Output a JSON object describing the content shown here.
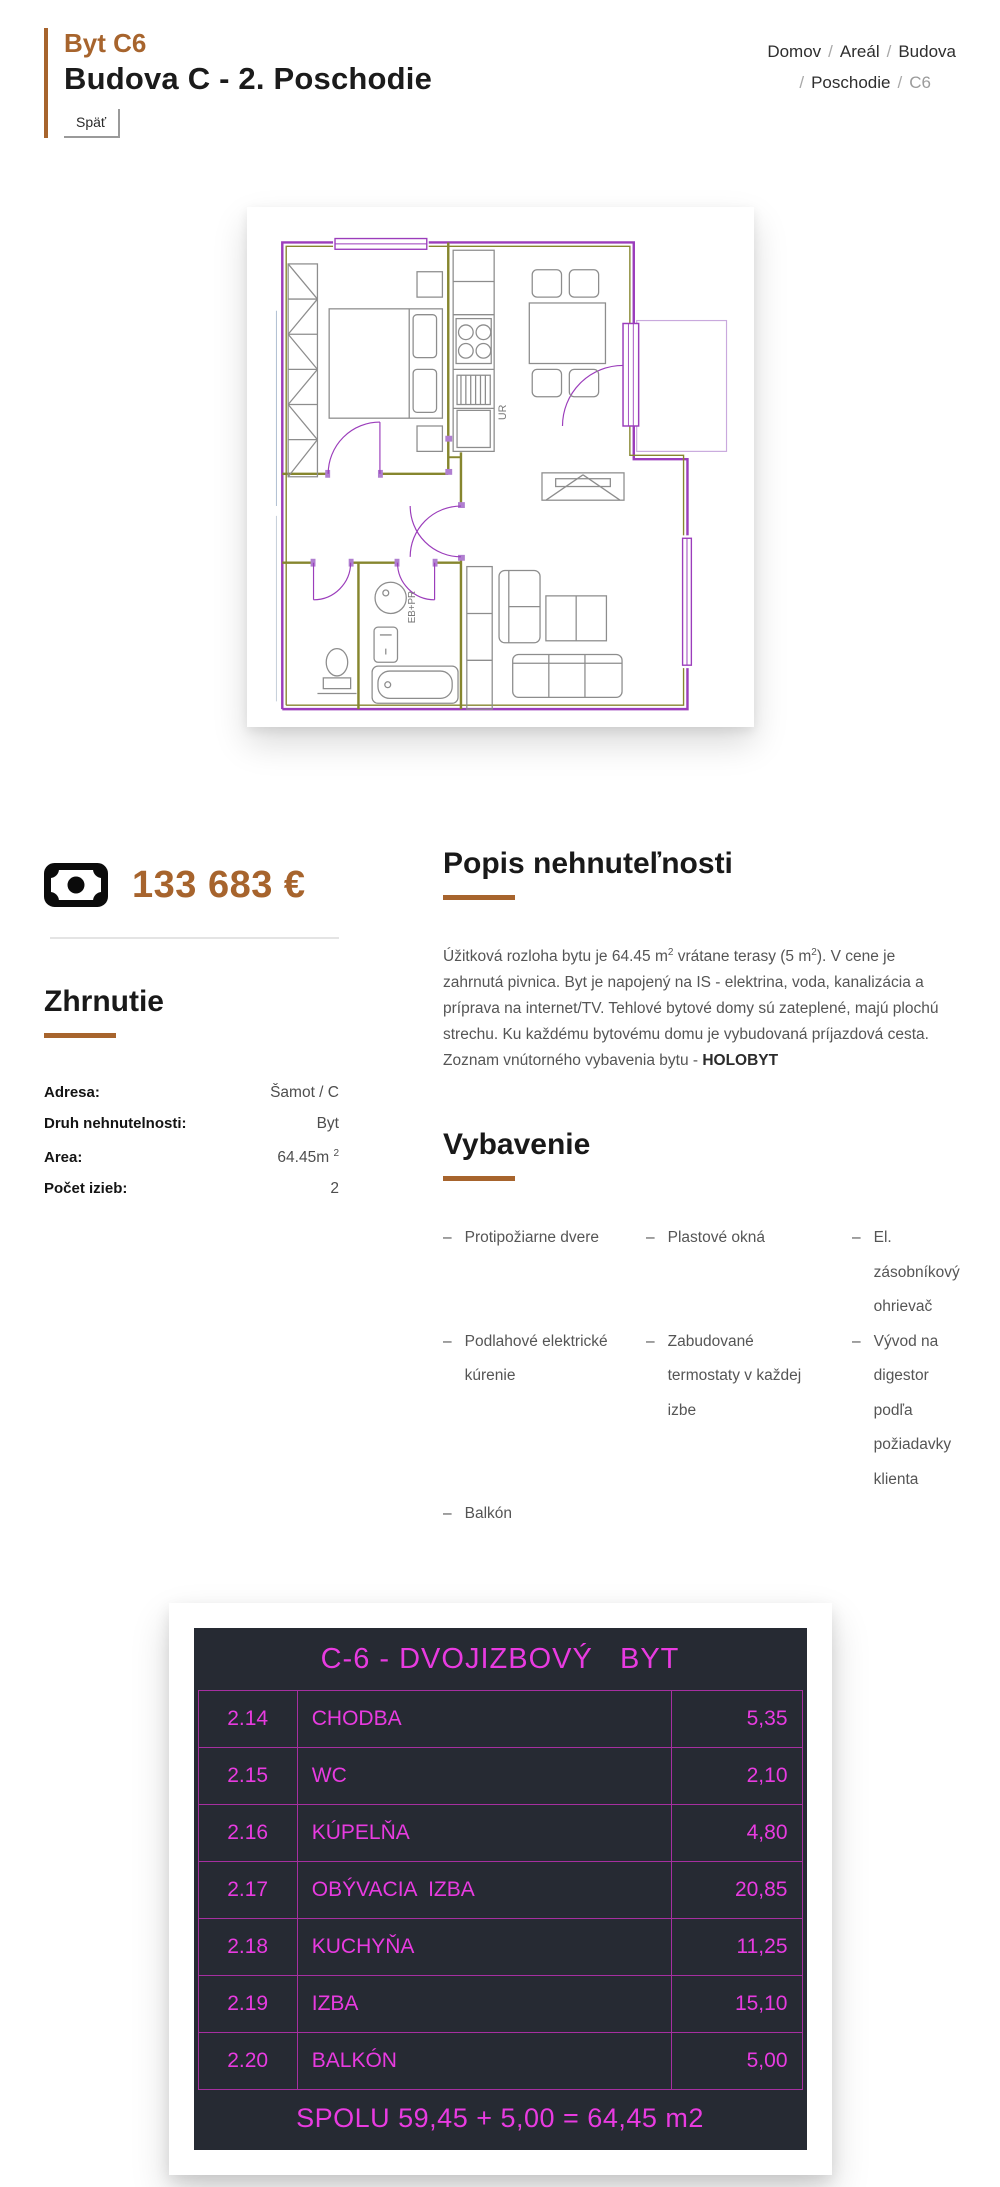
{
  "colors": {
    "accent": "#a7642d",
    "table_magenta": "#e83be0",
    "table_border": "#a62fa0",
    "table_bg": "#262a33"
  },
  "header": {
    "apt_code": "Byt C6",
    "title": "Budova C - 2. Poschodie",
    "back_label": "Späť",
    "breadcrumb": {
      "items": [
        "Domov",
        "Areál",
        "Budova",
        "Poschodie",
        "C6"
      ],
      "sep": "/"
    }
  },
  "floor_plan": {
    "label_ur": "UR",
    "label_washer": "EB+PR"
  },
  "price": {
    "icon": "banknote-icon",
    "amount": "133 683 €"
  },
  "summary": {
    "heading": "Zhrnutie",
    "rows": [
      {
        "label": "Adresa:",
        "value": "Šamot / C"
      },
      {
        "label": "Druh nehnutelnosti:",
        "value": "Byt"
      },
      {
        "label": "Area:",
        "value": "64.45m ",
        "value_sup": "2"
      },
      {
        "label": "Počet izieb:",
        "value": "2"
      }
    ]
  },
  "description": {
    "heading": "Popis nehnuteľnosti",
    "p1": "Úžitková rozloha bytu je 64.45 m",
    "sup1": "2",
    "p2": " vrátane terasy (5 m",
    "sup2": "2",
    "p3": "). V cene je zahrnutá pivnica. Byt je napojený na IS - elektrina, voda, kanalizácia a príprava na internet/TV. Tehlové bytové domy sú zateplené, majú plochú strechu. Ku každému bytovému domu je vybudovaná príjazdová cesta.",
    "line2_prefix": "Zoznam vnútorného vybavenia bytu - ",
    "line2_bold": "HOLOBYT"
  },
  "equipment": {
    "heading": "Vybavenie",
    "dash": "–",
    "items": [
      "Protipožiarne dvere",
      "Plastové okná",
      "El. zásobníkový ohrievač",
      "Podlahové elektrické kúrenie",
      "Zabudované termostaty v každej izbe",
      "Vývod na digestor podľa požiadavky klienta",
      "Balkón"
    ]
  },
  "room_table": {
    "title": "C-6 - DVOJIZBOVÝ   BYT",
    "rows": [
      {
        "num": "2.14",
        "name": "CHODBA",
        "area": "5,35"
      },
      {
        "num": "2.15",
        "name": "WC",
        "area": "2,10"
      },
      {
        "num": "2.16",
        "name": "KÚPELŇA",
        "area": "4,80"
      },
      {
        "num": "2.17",
        "name": "OBÝVACIA  IZBA",
        "area": "20,85"
      },
      {
        "num": "2.18",
        "name": "KUCHYŇA",
        "area": "11,25"
      },
      {
        "num": "2.19",
        "name": "IZBA",
        "area": "15,10"
      },
      {
        "num": "2.20",
        "name": "BALKÓN",
        "area": "5,00"
      }
    ],
    "total": "SPOLU 59,45 + 5,00 = 64,45 m2"
  }
}
